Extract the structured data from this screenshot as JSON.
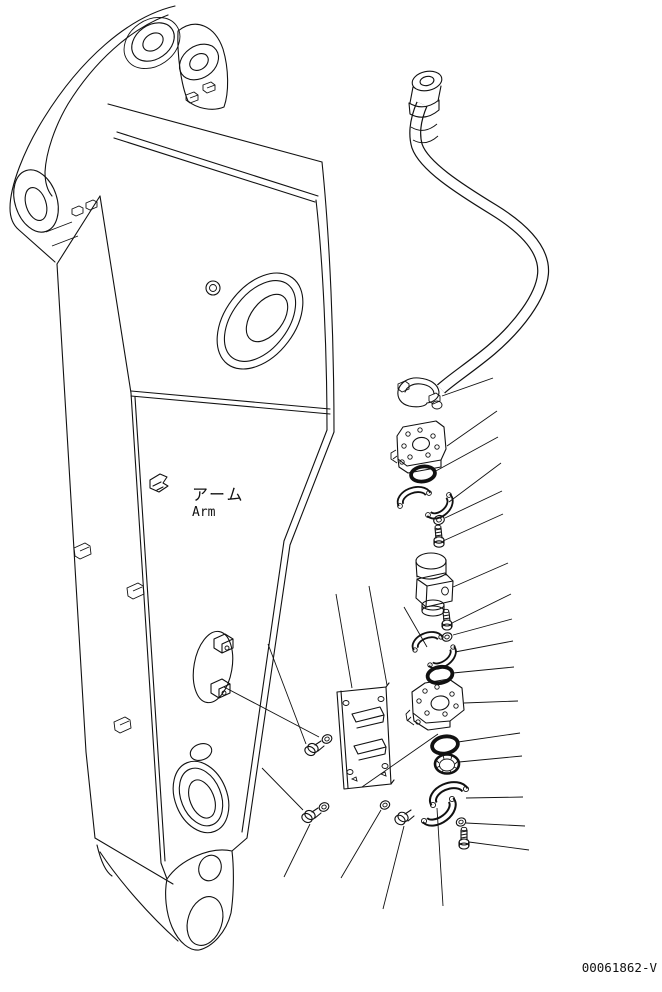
{
  "page": {
    "background_color": "#ffffff",
    "line_color": "#111111"
  },
  "labels": {
    "arm_jp": "アーム",
    "arm_en": "Arm",
    "drawing_number": "00061862-V"
  },
  "figure": {
    "type": "exploded-parts-line-drawing",
    "components": [
      "excavator-arm",
      "hydraulic-hose",
      "hose-end-split-flange",
      "valve-mount-plate-upper",
      "o-ring-upper",
      "split-flange-pair-upper",
      "washer",
      "bolt",
      "relief-valve-block",
      "valve-mount-plate-lower",
      "o-ring-lower",
      "ribbed-seal-ring",
      "split-flange-pair-lower",
      "mounting-bracket-plate",
      "mounting-bolts-and-washers"
    ]
  }
}
